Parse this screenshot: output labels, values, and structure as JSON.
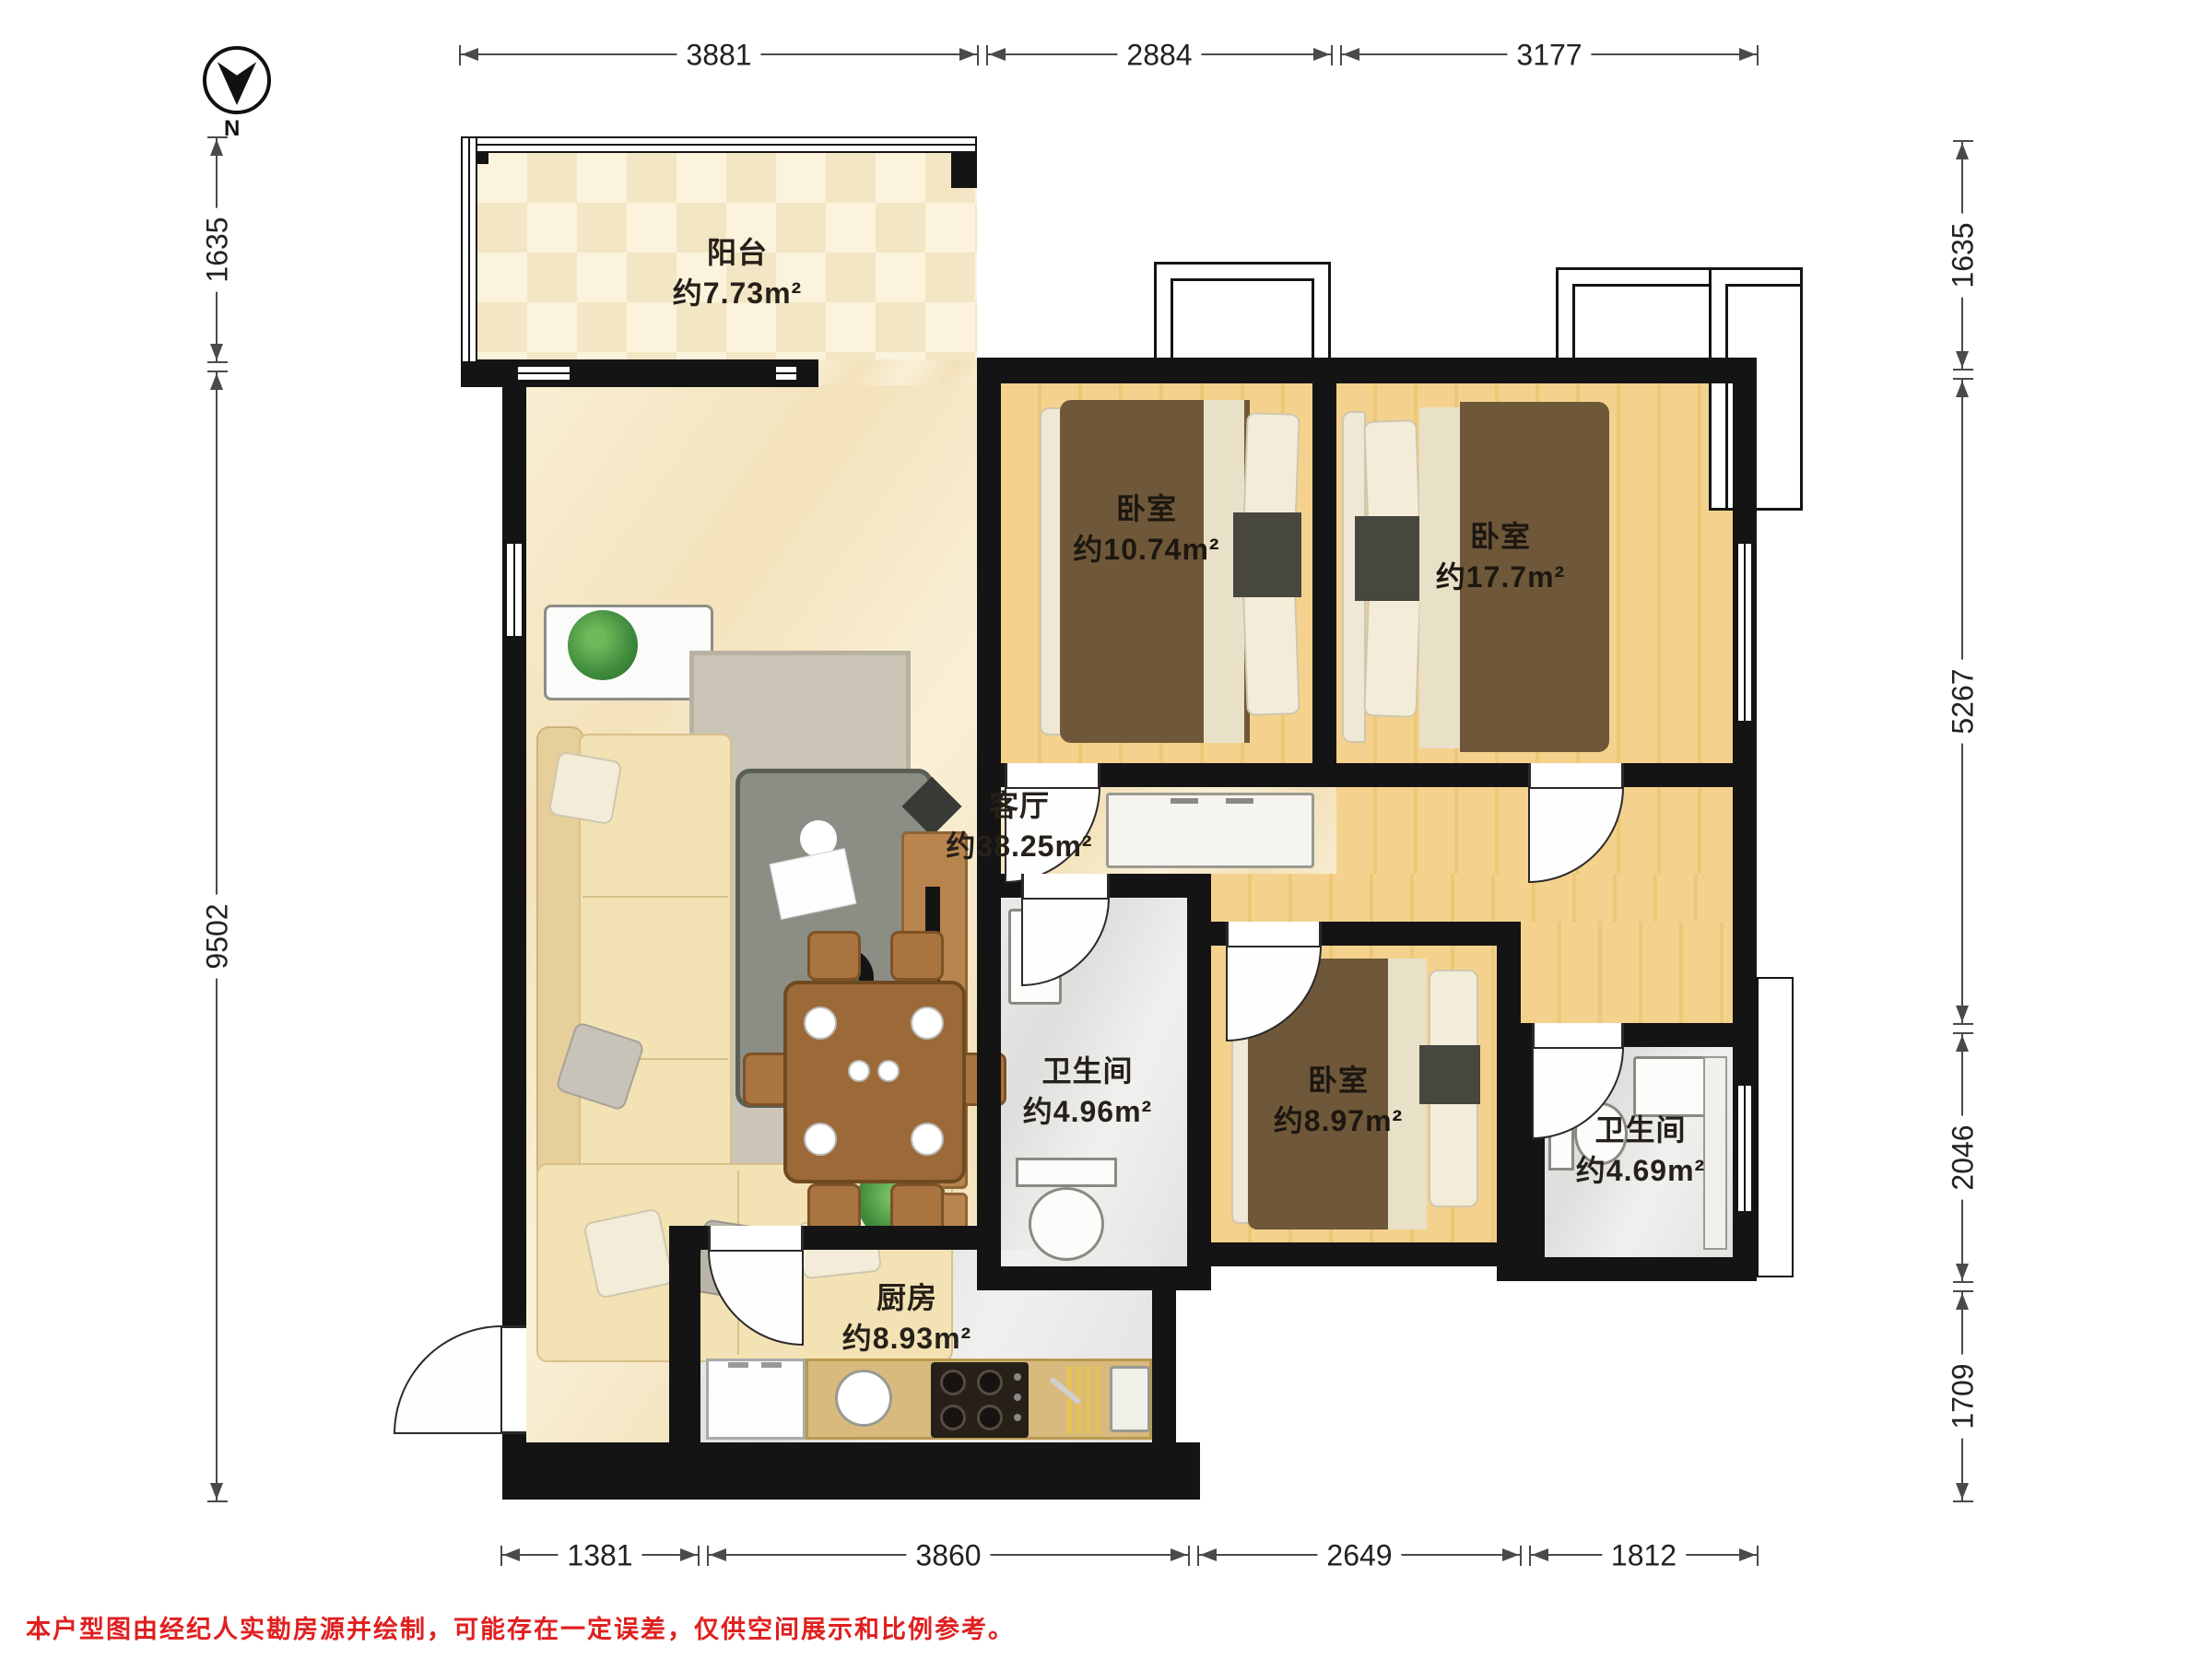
{
  "compass": {
    "label": "N"
  },
  "rooms": [
    {
      "name": "阳台",
      "area": "约7.73m²"
    },
    {
      "name": "卧室",
      "area": "约10.74m²"
    },
    {
      "name": "卧室",
      "area": "约17.7m²"
    },
    {
      "name": "客厅",
      "area": "约38.25m²"
    },
    {
      "name": "卫生间",
      "area": "约4.96m²"
    },
    {
      "name": "卧室",
      "area": "约8.97m²"
    },
    {
      "name": "卫生间",
      "area": "约4.69m²"
    },
    {
      "name": "厨房",
      "area": "约8.93m²"
    }
  ],
  "dimensions_mm": {
    "top": [
      "3881",
      "2884",
      "3177"
    ],
    "left": [
      "1635",
      "9502"
    ],
    "right": [
      "1635",
      "5267",
      "2046",
      "1709"
    ],
    "bottom": [
      "1381",
      "3860",
      "2649",
      "1812"
    ]
  },
  "footer": {
    "disclaimer": "本户型图由经纪人实勘房源并绘制，可能存在一定误差，仅供空间展示和比例参考。"
  },
  "colors": {
    "wall": "#141414",
    "wood_floor": "#f3cf86",
    "marble_floor": "#f6e9cd",
    "balcony_tile": "#f3e6c4",
    "gray_floor": "#e6e6e4",
    "bed_brown": "#6e5839",
    "counter_tan": "#d8ba7e",
    "disclaimer_red": "#e01f1f"
  }
}
